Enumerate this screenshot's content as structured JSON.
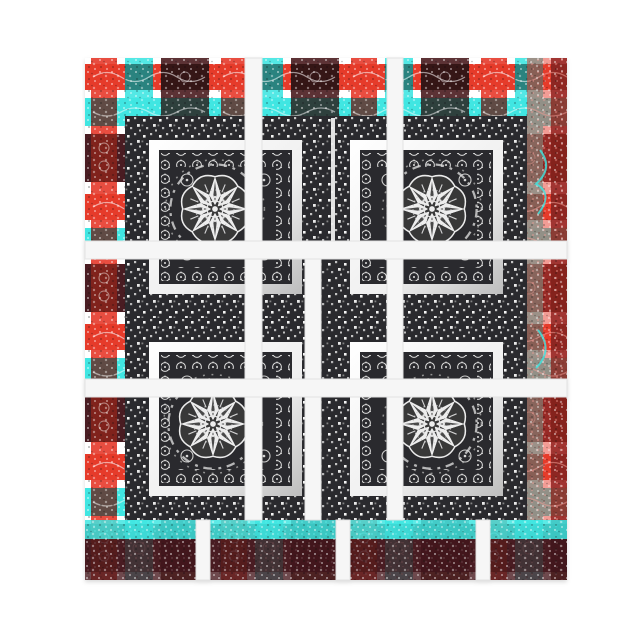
{
  "scene": {
    "kind": "product-photo",
    "subject": "square notepad printed with a bandana patchwork pattern",
    "medallion_count": 4
  },
  "palette": {
    "page": "#ffffff",
    "red": "#e63a2c",
    "cyan": "#3fe6e2",
    "dark": "#2b2b2d",
    "darkred": "#4a1c20",
    "tealdark": "#134d4a",
    "ink": "#ececec",
    "framelight": "#f2f2f2",
    "framegray": "#bdbdbd",
    "sash": "#f6f6f6",
    "sashedge": "#e3e3e3"
  },
  "pattern": {
    "border": "red, turquoise and black plaid bandana patchwork",
    "center": "black bandana blocks with white confetti dots, rosette rows, leaf wreaths and pinwheel star medallions",
    "sashing": "white quilt sashing strips"
  }
}
